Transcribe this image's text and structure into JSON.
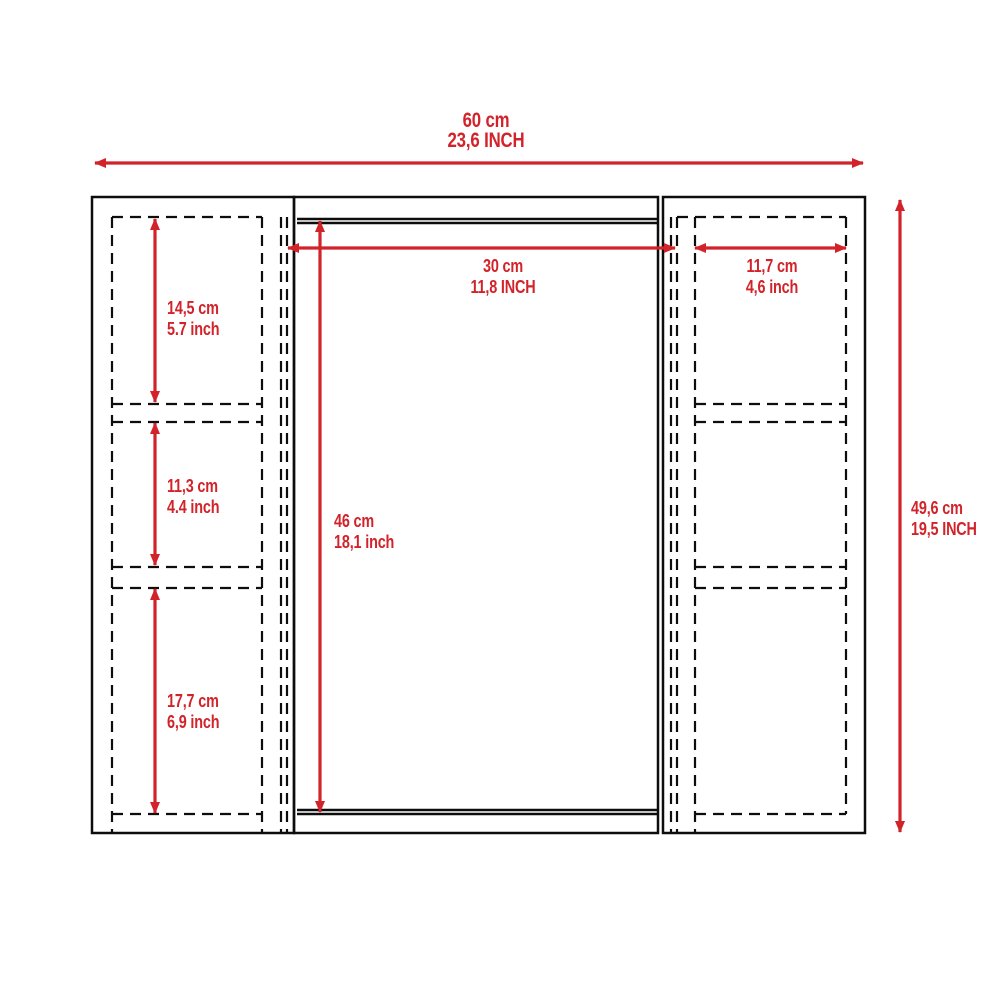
{
  "drawing": {
    "type": "cabinet-dimension-diagram",
    "colors": {
      "dimension_red": "#d2232a",
      "line_black": "#0d0d0d",
      "background": "#ffffff"
    },
    "dimensions": {
      "overall_width": {
        "cm": "60 cm",
        "inch": "23,6 INCH"
      },
      "overall_height": {
        "cm": "49,6 cm",
        "inch": "19,5 INCH"
      },
      "mirror_width": {
        "cm": "30 cm",
        "inch": "11,8 INCH"
      },
      "side_shelf_width": {
        "cm": "11,7 cm",
        "inch": "4,6 inch"
      },
      "mirror_height": {
        "cm": "46 cm",
        "inch": "18,1 inch"
      },
      "left_shelf_top": {
        "cm": "14,5 cm",
        "inch": "5.7 inch"
      },
      "left_shelf_middle": {
        "cm": "11,3 cm",
        "inch": "4.4 inch"
      },
      "left_shelf_bottom": {
        "cm": "17,7 cm",
        "inch": "6,9 inch"
      }
    }
  }
}
